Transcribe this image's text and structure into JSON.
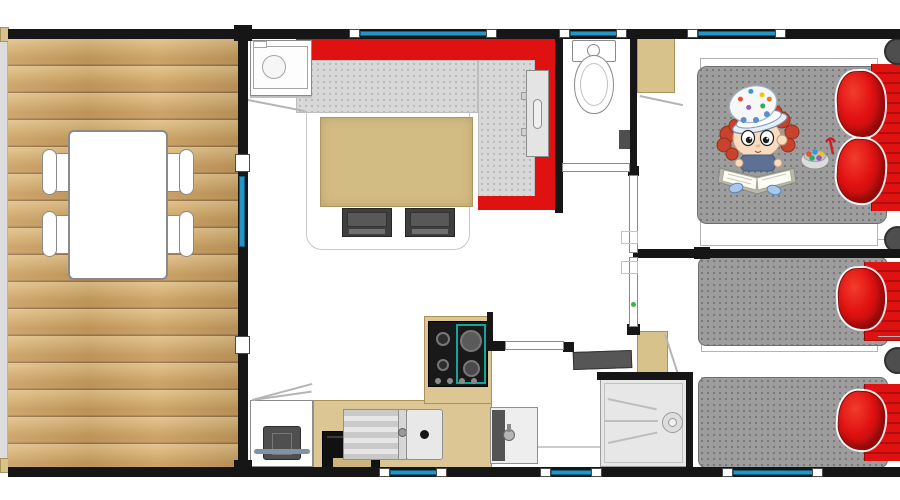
{
  "document": {
    "kind": "floor-plan",
    "description": "Top-down floor plan of a mobile home with wooden terrace, living room, kitchen, WC, shower room and two bedrooms; a cartoon child reading a book is drawn on the master bed",
    "visible_text": []
  },
  "palette": {
    "wall": "#161616",
    "window_glass": "#2395c8",
    "red": "#e01111",
    "red_dark": "#b00d0d",
    "seat_grey": "#d8d8d8",
    "mattress_grey": "#9d9d9d",
    "tan": "#d7c28c",
    "tan_border": "#a8935f",
    "counter": "#dcc794",
    "counter_border": "#ab9254",
    "dark_item": "#4c4c4c",
    "door_leaf": "#ffffff",
    "shower_floor": "#e7e7e7",
    "wood_a": "#e3c189",
    "wood_b": "#d6b173",
    "wood_c": "#c89d5e",
    "wood_line": "#9b744a",
    "hob_teal": "#17a398",
    "hinge_green": "#3cb44a",
    "deck_edge": "#dcdcdc"
  },
  "rooms": [
    {
      "name": "terrace",
      "items": [
        "dining-table",
        "chair",
        "chair",
        "chair",
        "chair",
        "entrance-door"
      ]
    },
    {
      "name": "living-room",
      "items": [
        "corner-sofa",
        "coffee-table",
        "stool",
        "stool",
        "wall-heater",
        "water-heater-cabinet",
        "rug"
      ]
    },
    {
      "name": "kitchen",
      "items": [
        "refrigerator",
        "oven",
        "gas-hob",
        "sink-with-drainer",
        "l-shaped-counter"
      ]
    },
    {
      "name": "wc",
      "items": [
        "toilet",
        "wall-box"
      ]
    },
    {
      "name": "hallway",
      "items": [
        "wardrobe",
        "door-wc",
        "door-master-bedroom",
        "door-twin-bedroom",
        "door-bathroom"
      ]
    },
    {
      "name": "bathroom",
      "items": [
        "hand-basin",
        "shower-tray",
        "radiator-shelf",
        "cabinet"
      ]
    },
    {
      "name": "master-bedroom",
      "items": [
        "double-bed",
        "pillow",
        "pillow",
        "bedside-stool",
        "bedside-stool",
        "reading-child-illustration",
        "candy-bowl-illustration"
      ]
    },
    {
      "name": "twin-bedroom",
      "items": [
        "single-bed",
        "single-bed",
        "pillow",
        "pillow",
        "bedside-stool"
      ]
    }
  ],
  "openings": {
    "top_windows": 3,
    "bottom_windows": 3,
    "terrace_door": 1
  }
}
